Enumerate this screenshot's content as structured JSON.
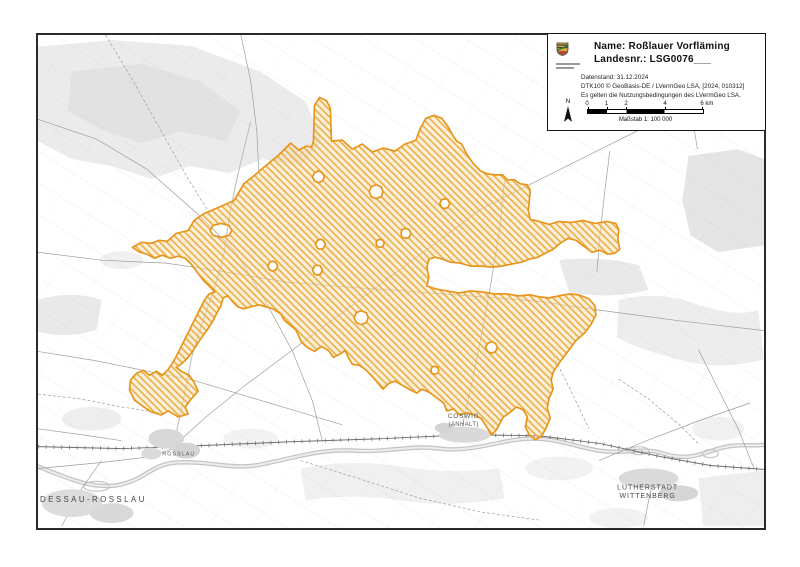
{
  "colors": {
    "area_boundary": "#E8951C",
    "area_hatch": "#EAA93C",
    "area_tint": "#F6E2B4",
    "frame": "#2A2A2A",
    "topo_line": "#9C9C9C",
    "topo_fill": "#E7E7E7",
    "water": "#C4C4C4",
    "label_text": "#474747"
  },
  "legend": {
    "name_line": "Name: Roßlauer Vorfläming",
    "number_line": "Landesnr.: LSG0076___",
    "info_lines": [
      "Datenstand: 31.12.2024",
      "DTK100 © GeoBasis-DE / LVermGeo LSA, [2024, 010312]",
      "Es gelten die Nutzungsbedingungen des LVermGeo LSA."
    ],
    "north_label": "N",
    "scale": {
      "ticks": [
        "0",
        "1",
        "2",
        "4",
        "6 km"
      ],
      "caption": "Maßstab 1: 100 000"
    }
  },
  "map": {
    "labels": {
      "dessau_rosslau": "DESSAU-ROSSLAU",
      "rosslau": "ROSSLAU",
      "coswig": [
        "COSWIG",
        "(ANHALT)"
      ],
      "wittenberg": [
        "LUTHERSTADT",
        "WITTENBERG"
      ]
    }
  }
}
